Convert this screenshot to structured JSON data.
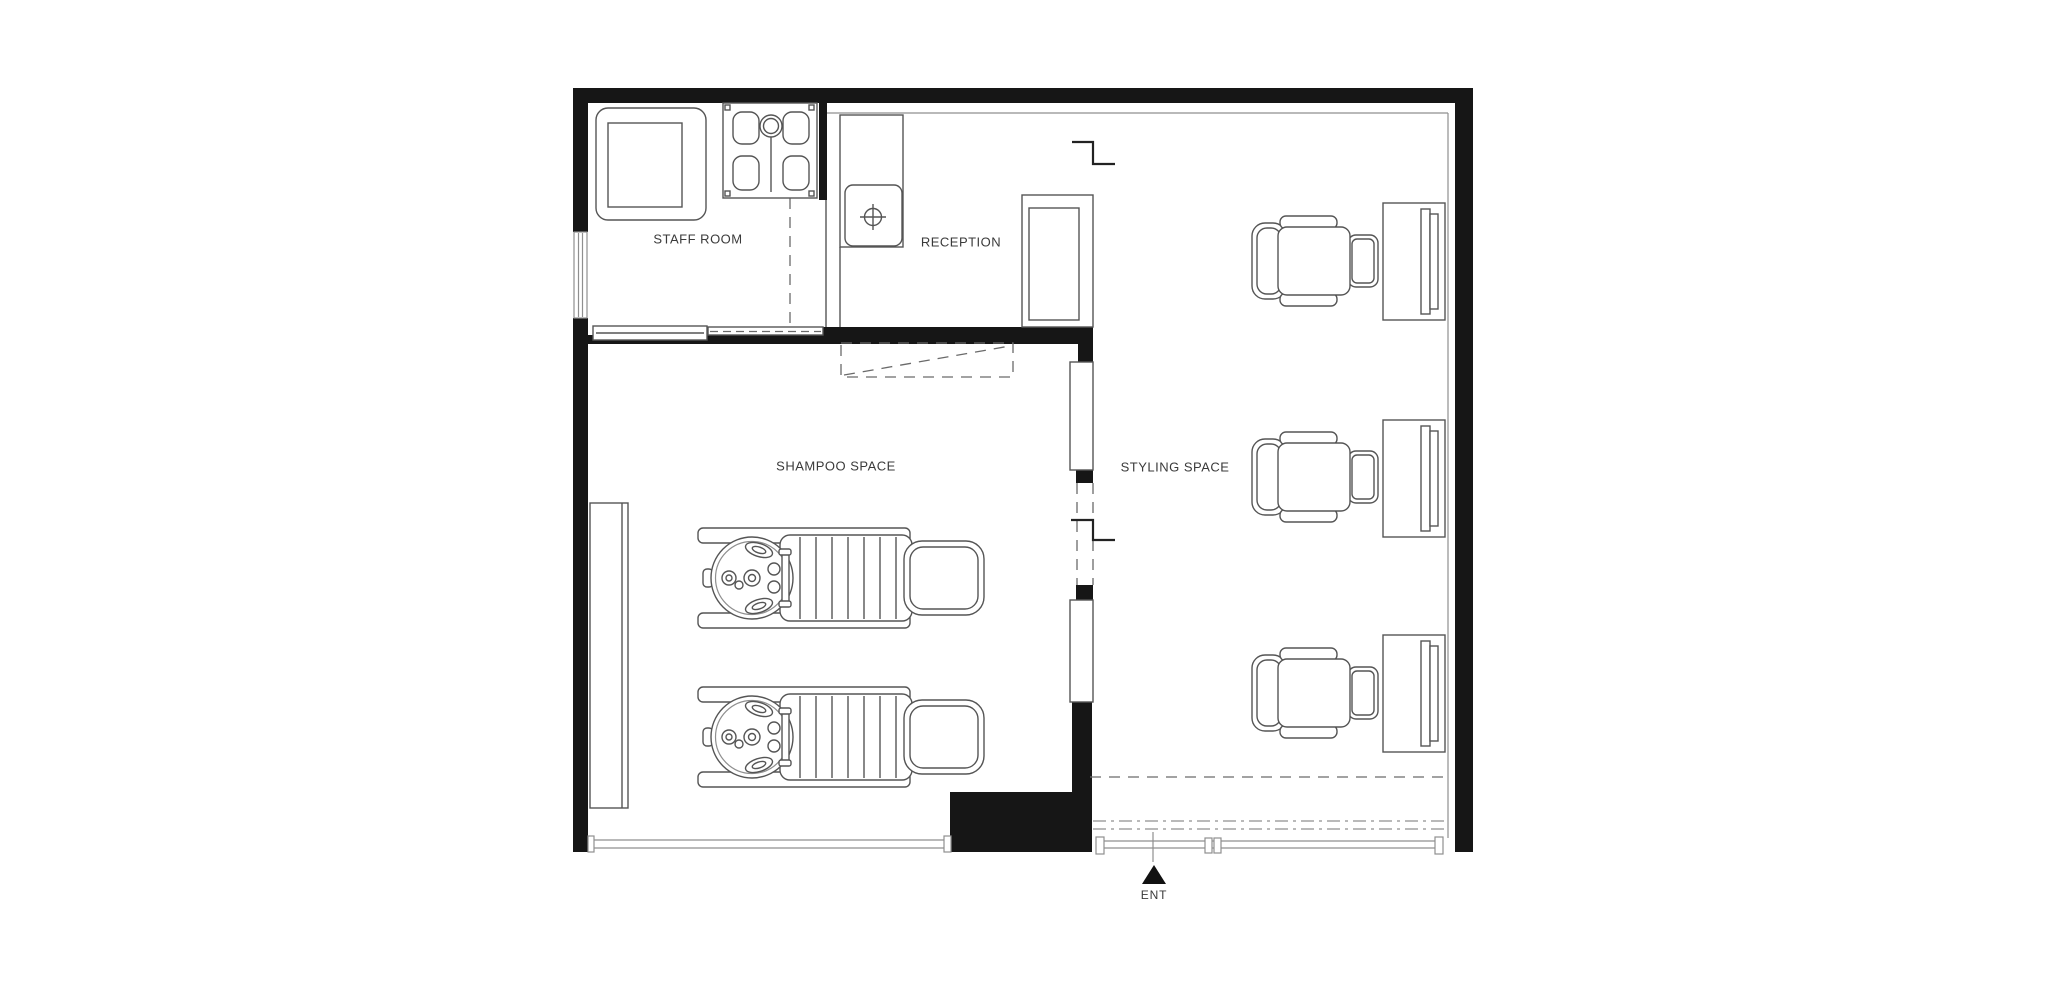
{
  "plan": {
    "title": "Hair salon floor plan",
    "rooms": [
      {
        "id": "staff-room",
        "label": "STAFF ROOM"
      },
      {
        "id": "reception",
        "label": "RECEPTION"
      },
      {
        "id": "shampoo-space",
        "label": "SHAMPOO SPACE"
      },
      {
        "id": "styling-space",
        "label": "STYLING SPACE"
      }
    ],
    "entrance": {
      "label": "ENT"
    },
    "furniture": {
      "styling_stations": 3,
      "styling_chairs": 3,
      "shampoo_units": 2,
      "reception_desk": 1,
      "sink_counter": 1,
      "shower": 1,
      "staff_table": 1,
      "bench": 1
    },
    "colors": {
      "wall": "#161616",
      "line": "#555555",
      "line_light": "#8f8f8f",
      "dashc": "#6a6a6a",
      "text": "#3a3a3a",
      "bg": "#ffffff"
    }
  }
}
